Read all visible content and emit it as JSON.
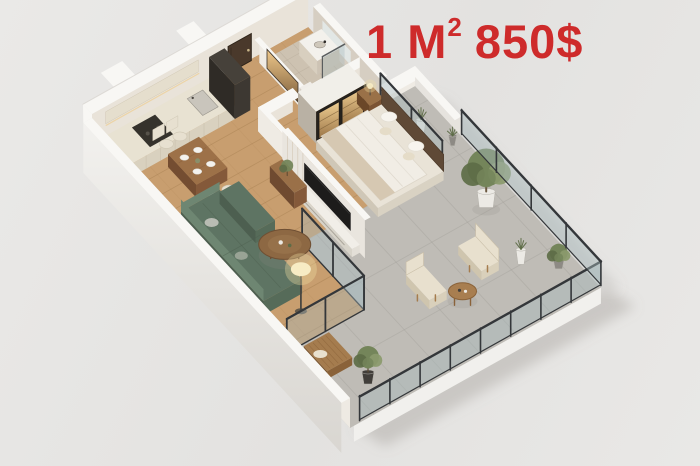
{
  "price_label": {
    "full": "1 M² 850$",
    "left": "1 M",
    "sup": "2",
    "right": "850$"
  },
  "scene": {
    "type": "3d-floorplan-render"
  },
  "palette": {
    "accent": "#ce2b2b",
    "bg": "#e7e6e4",
    "wall_top": "#f8f7f4",
    "wall_inner": "#e9e3d9",
    "wall_face": "#efebe4",
    "marble": "#d6cec2",
    "wood": "#c89e6f",
    "wood_line": "#a87f52",
    "concrete": "#bfbcb6",
    "concrete_line": "#a5a29c",
    "bath_tile": "#cdc2b1",
    "bath_line": "#b1a693",
    "cab_top": "#e8e2d2",
    "cab_face": "#d9d1bf",
    "cab_side": "#cec5b2",
    "counter_dark": "#35322c",
    "unit_dark": "#2f2b26",
    "unit_side": "#3d3832",
    "unit_top": "#46413a",
    "door": "#4a392b",
    "table_top": "#9d7148",
    "table_side": "#84593a",
    "table_end": "#744d31",
    "chair": "#e7e0d0",
    "sofa": "#5e7463",
    "sofa_light": "#6e8672",
    "sofa_dark": "#4d5f50",
    "pillow": "#b9bcb3",
    "pillow2": "#99a395",
    "tv": "#1d1c1b",
    "media": "#e9e5de",
    "console": "#f1eee8",
    "duvet": "#f1ede5",
    "throw": "#d6c8b2",
    "headboard": "#5f4936",
    "white_pillow": "#f7f4ee",
    "frame": "#34373a",
    "glass": "#a8babd",
    "plant": "#74855a",
    "plant_dark": "#5d6c47",
    "plant_light": "#8b9a6d",
    "pot_white": "#eceae5",
    "pot_gray": "#8d8a84",
    "pot_dark": "#413e3a",
    "wood_chair": "#a57c4e",
    "wood_chair_dark": "#8a6239",
    "cushion": "#e8e0ce",
    "lamp": "#f7ecc4",
    "halo": "#f0dfa2",
    "fascia": "#f1f0ed",
    "fascia_shade": "#e3e1dc",
    "shadow": "#8f8c86",
    "bed_base": "#e9e3d7",
    "bed_base_se": "#d9d2c3",
    "bed_base_sw": "#cfc7b7",
    "vanity_top": "#f3f1ec",
    "vanity_face": "#cdc3b4",
    "tray": "#c6bdad"
  }
}
